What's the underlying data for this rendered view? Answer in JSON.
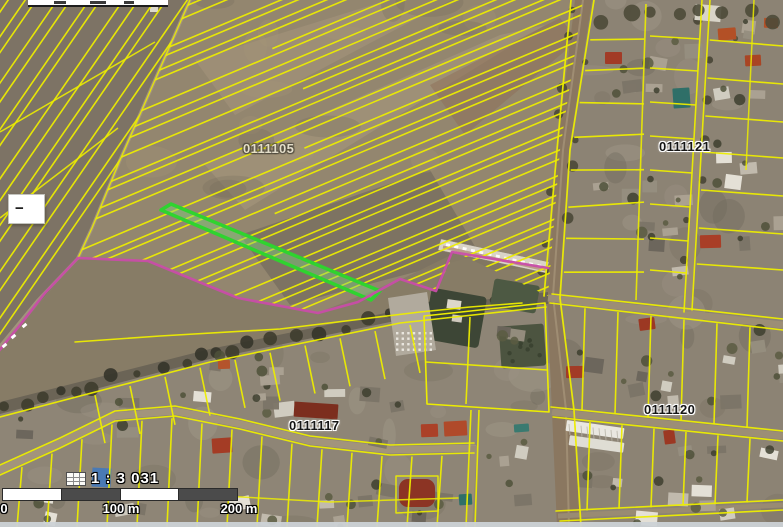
{
  "map_labels": {
    "sector_field": "0111105",
    "sector_ne": "0111121",
    "sector_se": "0111120",
    "sector_s": "0111117"
  },
  "scale_indicator": {
    "icon": "map-scale-icon",
    "ratio_text": "1 : 3 031"
  },
  "scale_bar": {
    "label_start": "0",
    "label_middle": "100 m",
    "label_end": "200 m"
  },
  "controls": {
    "collapse_glyph": "−"
  },
  "colors": {
    "parcel_line": "#eded00",
    "selected_parcel_stroke": "#2fd32f",
    "selected_parcel_fill": "rgba(125,215,125,0.42)",
    "boundary_line": "#c84da8",
    "scale_bar_dark": "#4b4b4b",
    "label_text": "#151515",
    "label_halo": "#ffffff"
  }
}
